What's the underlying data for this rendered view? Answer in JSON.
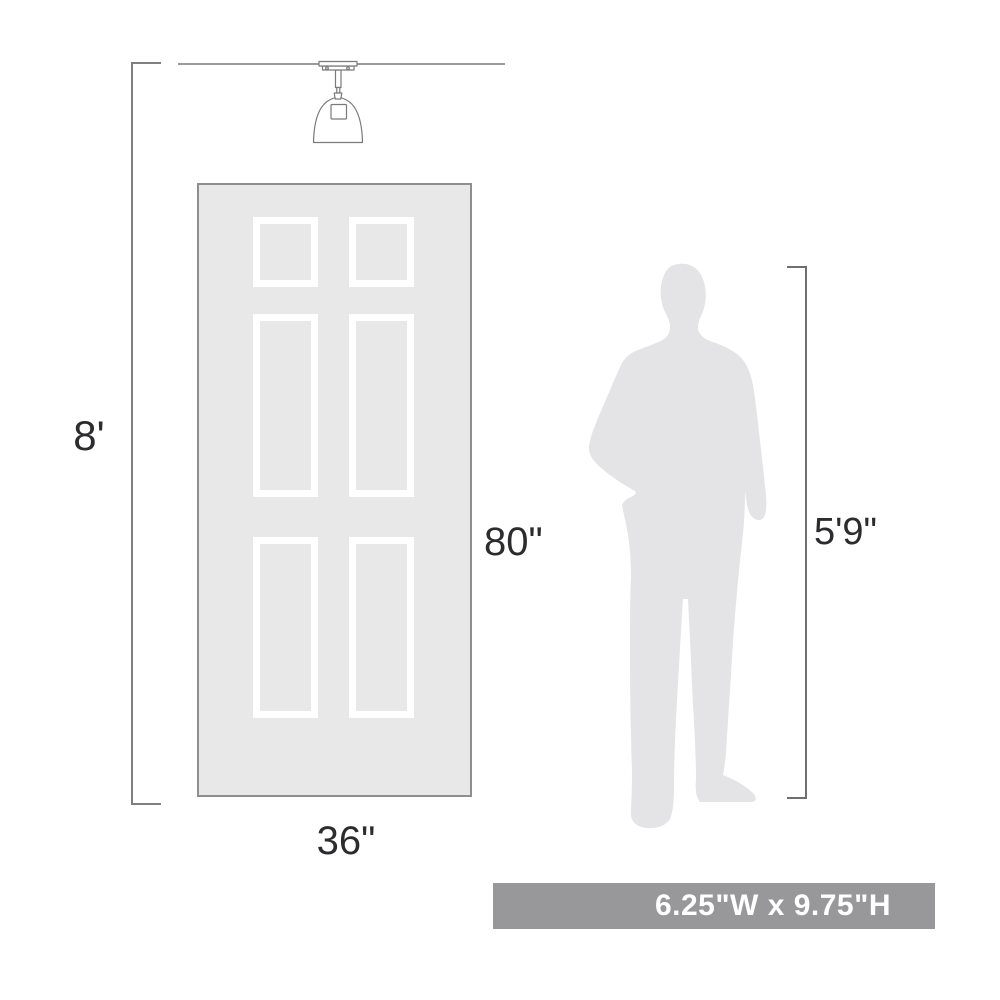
{
  "diagram": {
    "ceiling_height_label": "8'",
    "door": {
      "height_label": "80\"",
      "width_label": "36\""
    },
    "person": {
      "height_label": "5'9\""
    },
    "product": {
      "dimensions_label": "6.25\"W x 9.75\"H"
    },
    "icons": {
      "light_fixture": "semi-flush-ceiling-light-icon",
      "person": "man-silhouette-icon"
    },
    "colors": {
      "door_fill": "#e8e8e9",
      "panel_frame": "#ffffff",
      "silhouette_fill": "#e4e4e6",
      "dimension_line": "#7d7d7f",
      "ceiling_line": "#9a9a9c",
      "fixture_outline": "#7a7a7c",
      "label_text": "#2c2c2e",
      "banner_background": "#98989b",
      "banner_text": "#ffffff"
    }
  }
}
